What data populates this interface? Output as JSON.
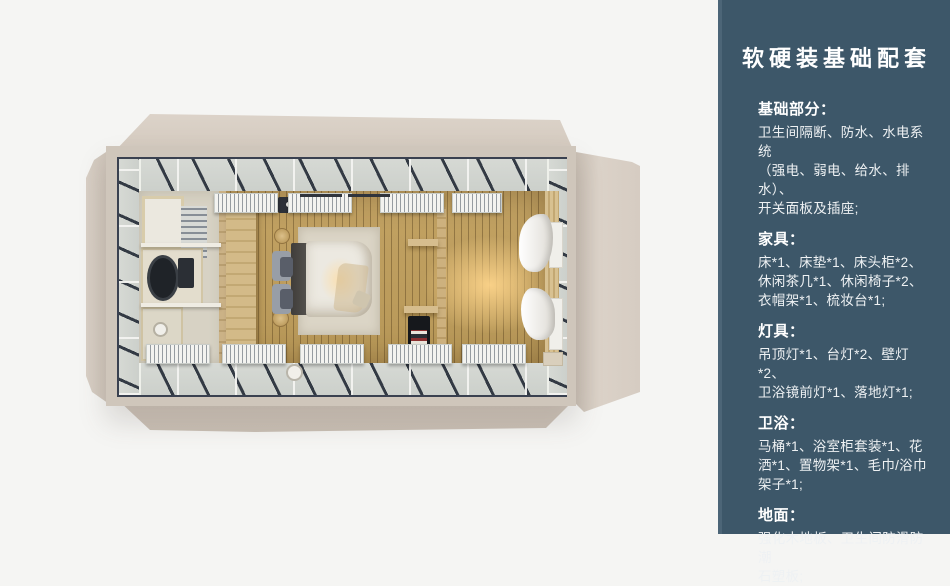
{
  "sidebar": {
    "title": "软硬装基础配套",
    "sections": [
      {
        "heading": "基础部分：",
        "body": "卫生间隔断、防水、水电系统\n（强电、弱电、给水、排水）、\n开关面板及插座;"
      },
      {
        "heading": "家具：",
        "body": "床*1、床垫*1、床头柜*2、\n休闲茶几*1、休闲椅子*2、\n衣帽架*1、梳妆台*1;"
      },
      {
        "heading": "灯具：",
        "body": "吊顶灯*1、台灯*2、壁灯*2、\n卫浴镜前灯*1、落地灯*1;"
      },
      {
        "heading": "卫浴：",
        "body": "马桶*1、浴室柜套装*1、花\n洒*1、置物架*1、毛巾/浴巾\n架子*1;"
      },
      {
        "heading": "地面：",
        "body": "强化木地板、卫生间防滑防潮\n石塑板;"
      }
    ]
  },
  "colors": {
    "page_bg": "#f5f5f3",
    "sidebar_bg": "#3d5769",
    "sidebar_accent": "#4c6577",
    "sidebar_text": "#f2f5f6",
    "shell_beige": "#d6ccc1",
    "steel_frame": "#3a4150",
    "wood_floor": "#c09e5e",
    "warm_glow": "#ffd693"
  }
}
